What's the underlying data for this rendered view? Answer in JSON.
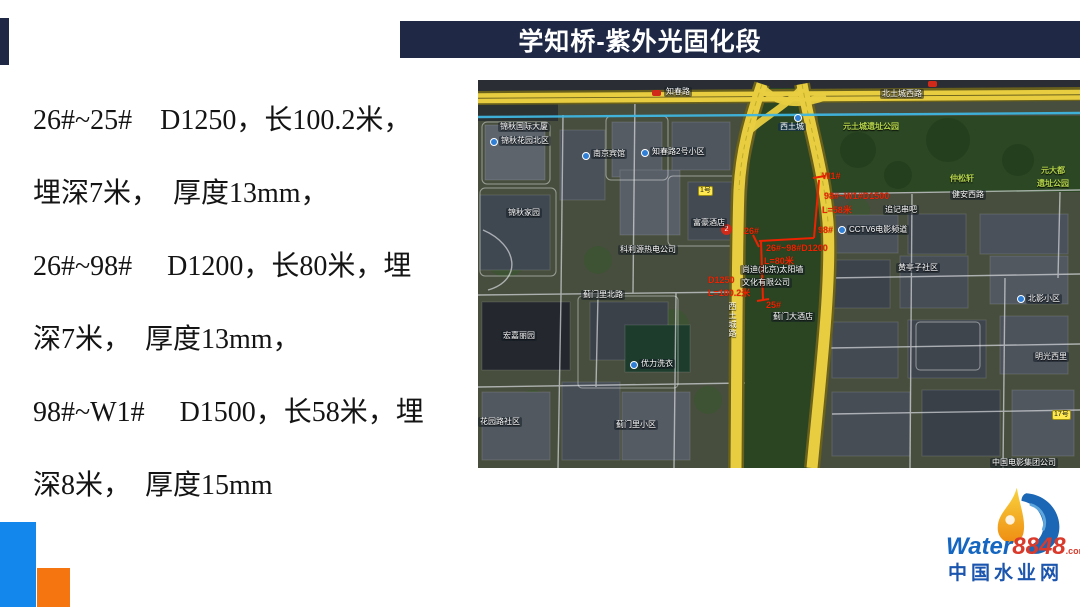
{
  "title": {
    "text": "学知桥-紫外光固化段"
  },
  "body": {
    "lines": [
      "26#~25#　D1250，长100.2米，",
      "埋深7米，　厚度13mm，",
      "26#~98#　 D1200，长80米，埋",
      "深7米，　厚度13mm，",
      "98#~W1#　 D1500，长58米，埋",
      "深8米，　厚度15mm"
    ]
  },
  "map": {
    "road_labels": {
      "zhichun": "知春路",
      "beitucheng": "北土城西路",
      "xitucheng_road": "西土城路"
    },
    "station": "西土城",
    "badge_2": "2",
    "badge_1hao": "1号",
    "badge_17hao": "17号",
    "area_labels": [
      "锦秋国际大厦",
      "锦秋花园北区",
      "锦秋家园",
      "南京宾馆",
      "知春路2号小区",
      "富豪酒店",
      "科利源热电公司",
      "蓟门里北路",
      "宏嘉丽园",
      "优力洗衣",
      "蓟门里小区",
      "花园路社区",
      "蓟门大酒店",
      "尚迪(北京)太阳墙",
      "文化有限公司",
      "健安西路",
      "追记串吧",
      "CCTV6电影频道",
      "黄亭子社区",
      "北影小区",
      "明光西里",
      "中国电影集团公司"
    ],
    "green_labels": [
      "元土城遗址公园",
      "仲松轩",
      "元大都",
      "遗址公园"
    ],
    "red": {
      "w1": "W1#",
      "seg_98w1_l1": "98#~W1#D1500",
      "seg_98w1_l2": "L=58米",
      "p98": "98#",
      "p26": "26#",
      "seg_2698_l1": "26#~98#D1200",
      "seg_2698_l2": "L=80米",
      "p25": "25#",
      "seg_2625_l1": "D1250",
      "seg_2625_l2": "L=100.2米"
    }
  },
  "logo": {
    "water": "Water",
    "num": "8848",
    "suffix": ".com",
    "cn": "中国水业网"
  },
  "colors": {
    "title_bar": "#1f2946",
    "accent_blue": "#1487ec",
    "accent_orange": "#f57511",
    "road_yellow": "#e8cd40",
    "annotation_red": "#ee2200",
    "logo_blue": "#1b55ad",
    "logo_red": "#d93a2b"
  }
}
